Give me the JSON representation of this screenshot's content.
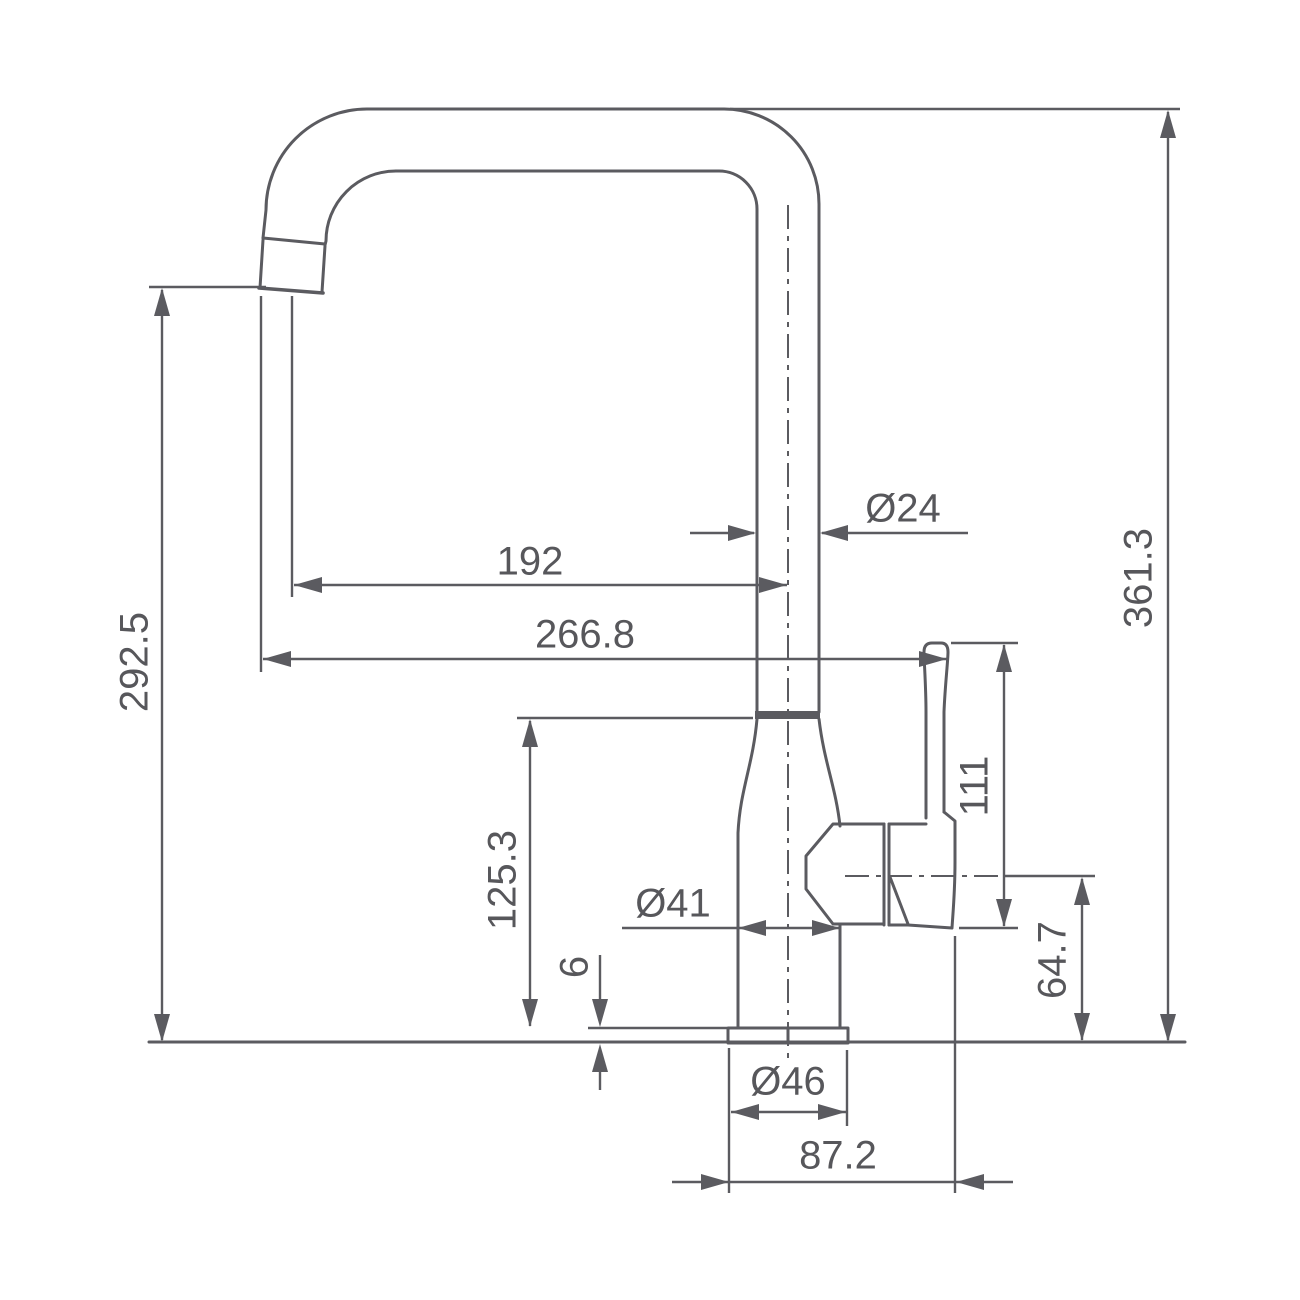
{
  "drawing": {
    "title": "kitchen-faucet-dimension-drawing",
    "units": "mm",
    "dimensions": {
      "spout_outlet_height": "292.5",
      "overall_height": "361.3",
      "spout_reach_to_center": "192",
      "overall_reach": "266.8",
      "spout_tube_diameter": "Ø24",
      "handle_height": "111",
      "valve_center_height": "64.7",
      "body_height": "125.3",
      "base_plate_thickness": "6",
      "body_diameter": "Ø41",
      "base_diameter": "Ø46",
      "base_to_handle_reach": "87.2"
    },
    "colors": {
      "line": "#5b5b60",
      "text": "#57575b",
      "background": "#ffffff"
    }
  }
}
